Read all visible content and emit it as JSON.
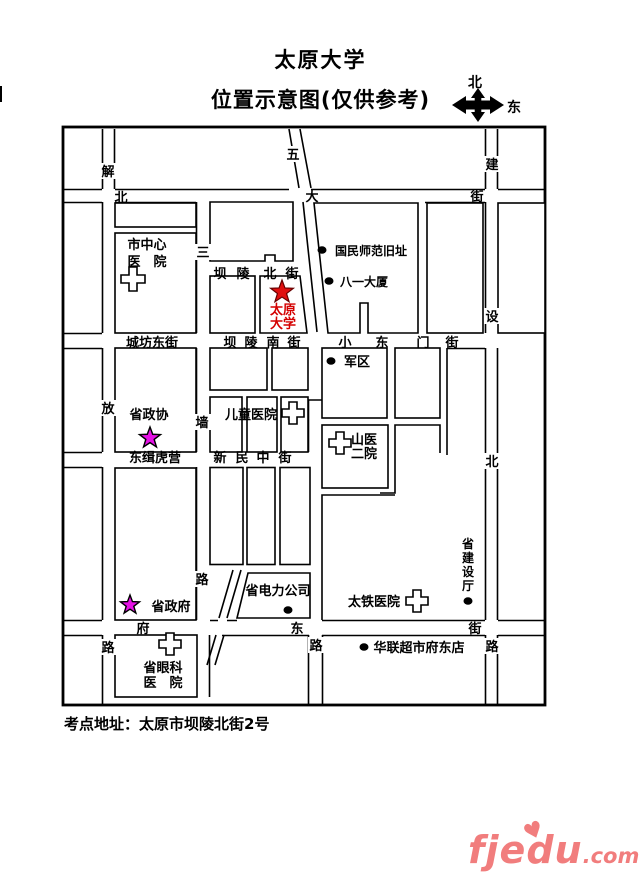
{
  "title": "太原大学",
  "subtitle": "位置示意图(仅供参考)",
  "compass": {
    "north": "北",
    "east": "东"
  },
  "address": "考点地址：太原市坝陵北街2号",
  "logo": {
    "name": "fjedu",
    "tld": ".com",
    "heart": "♥"
  },
  "map": {
    "streets": {
      "beidajie": [
        "北",
        "大",
        "街"
      ],
      "jiefanglu": [
        "解",
        "放",
        "路"
      ],
      "wuyilu": [
        "五"
      ],
      "sanqianglu": [
        "三",
        "墙",
        "路"
      ],
      "balingbeijie": [
        "坝",
        "陵",
        "北",
        "街"
      ],
      "chengfangdongjie": "城坊东街",
      "balingnanjie": [
        "坝",
        "陵",
        "南",
        "街"
      ],
      "xiaodongmenjie": [
        "小",
        "东",
        "门",
        "街"
      ],
      "dongjihuying": "东缉虎营",
      "xinminzhongjie": [
        "新",
        "民",
        "中",
        "街"
      ],
      "fudongjie": [
        "府",
        "东",
        "街"
      ],
      "jianshebeilu": [
        "建",
        "设",
        "北",
        "路"
      ],
      "lu": "路"
    },
    "landmarks": {
      "shizhongxin": [
        "市中心",
        "医　院"
      ],
      "guominshifan": "国民师范旧址",
      "bayidasha": "八一大厦",
      "taiyuandaxue": [
        "太原",
        "大学"
      ],
      "junqu": "军区",
      "shengzhengxie": "省政协",
      "ertongyiyuan": "儿童医院",
      "shanyi": [
        "山医",
        "二院"
      ],
      "shengzhengfu": "省政府",
      "shengdianli": "省电力公司",
      "taitie": "太铁医院",
      "shengjianshe": [
        "省",
        "建",
        "设",
        "厅"
      ],
      "hualian": "华联超市府东店",
      "shengyanke": [
        "省眼科",
        "医　院"
      ]
    }
  }
}
